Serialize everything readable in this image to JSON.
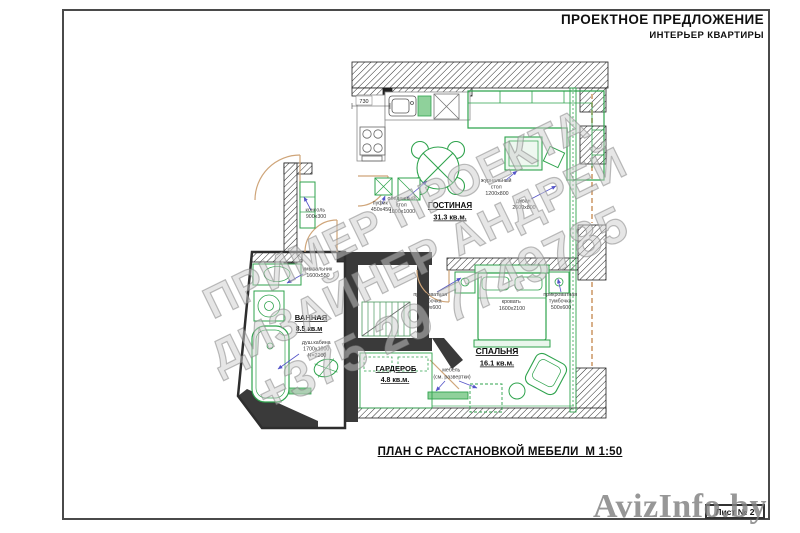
{
  "header": {
    "title": "ПРОЕКТНОЕ ПРЕДЛОЖЕНИЕ",
    "subtitle": "ИНТЕРЬЕР КВАРТИРЫ"
  },
  "plan": {
    "rooms": {
      "living": {
        "name": "ГОСТИНАЯ",
        "area": "31.3 кв.м."
      },
      "bedroom": {
        "name": "СПАЛЬНЯ",
        "area": "16.1 кв.м."
      },
      "bathroom": {
        "name": "ВАННАЯ",
        "area": "8.5 кв.м"
      },
      "wardrobe": {
        "name": "ГАРДЕРОБ",
        "area": "4.8 кв.м."
      }
    },
    "furniture": {
      "console": {
        "lines": [
          "консоль",
          "900х300"
        ]
      },
      "pouf": {
        "lines": [
          "пуфик",
          "450х450"
        ]
      },
      "dining_table": {
        "lines": [
          "обеденный",
          "стол",
          "1000х1000"
        ]
      },
      "coffee_table": {
        "lines": [
          "журнальный",
          "стол",
          "1200х800"
        ]
      },
      "sofa": {
        "lines": [
          "диван",
          "2600х800"
        ]
      },
      "bed": {
        "lines": [
          "кровать",
          "1600х2100"
        ]
      },
      "nightstand_left": {
        "lines": [
          "прикроватная",
          "тумбочка",
          "500х600"
        ]
      },
      "nightstand_right": {
        "lines": [
          "прикроватная",
          "тумбочка",
          "500х600"
        ]
      },
      "washbasin": {
        "lines": [
          "умывальник",
          "1600х550"
        ]
      },
      "shower": {
        "lines": [
          "душ.кабина",
          "1700х1000",
          "Н=2200"
        ]
      },
      "bedroom_set": {
        "lines": [
          "мебель",
          "(см. развертки)"
        ]
      }
    },
    "dimensions": {
      "kitchen_niche": "730"
    }
  },
  "watermark": {
    "line1": "ПРИМЕР ПРОЕКТА",
    "line2": "ДИЗАЙНЕР АНДРЕЙ",
    "line3": "+375 29 7749785"
  },
  "footer": {
    "caption": "ПЛАН С РАССТАНОВКОЙ МЕБЕЛИ  М 1:50",
    "sheet": "Лист № 2"
  },
  "site_watermark": "AvizInfo.by",
  "colors": {
    "furniture_green": "#2fa34d",
    "wall_dark": "#3a3a3a",
    "door_tan": "#cfa579",
    "arrow_blue": "#5555c8",
    "watermark_gray": "#b0b0b0",
    "site_gray": "#949494"
  }
}
